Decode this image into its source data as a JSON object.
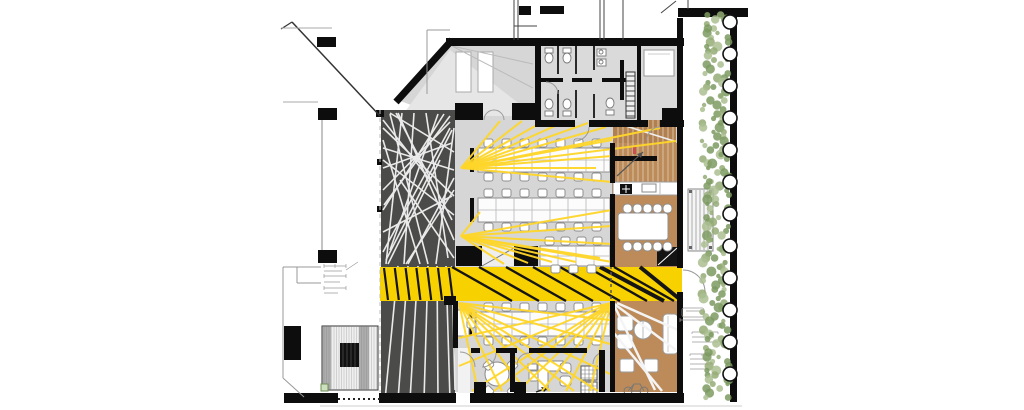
{
  "meta": {
    "title": "office-floor-plan",
    "description": "Architectural floor plan of an office level: entry ramp top-left, sanitary block top, dark gallery with white web pattern on the left, open office with three desk rows, yellow circulation band with black stripes, wooden zone with stair, kitchenette and meeting table, lounge bottom-right, outdoor deck with bench and planting hedge along the right edge."
  },
  "palette": {
    "wall": "#0d0d0d",
    "floor_grey": "#d6d6d6",
    "floor_grey_light": "#e4e4e4",
    "bath_grey": "#dadada",
    "dark_zone": "#4b4b49",
    "web_line": "#eaeaea",
    "band_yellow": "#f8d100",
    "stripe_black": "#151515",
    "ray_yellow": "#ffd629",
    "wood_brown": "#bd8b59",
    "wood_brown_dark": "#b28050",
    "tread_line": "#dcc9ab",
    "furniture_stroke": "#8f8f8f",
    "white": "#ffffff",
    "hedge_green_dark": "#7d9a60",
    "hedge_green": "#94ac75",
    "hedge_green_light": "#abc092",
    "door_arc": "#9a9a9a",
    "annotation_grey": "#9a9a9a",
    "dashed_grey": "#bdbdbd",
    "ground_line": "#cfcfcf"
  },
  "zones": [
    {
      "name": "entry-ramp",
      "fill": "floor_grey"
    },
    {
      "name": "sanitary-block",
      "fill": "bath_grey"
    },
    {
      "name": "dark-gallery",
      "fill": "dark_zone"
    },
    {
      "name": "open-office-upper",
      "fill": "floor_grey"
    },
    {
      "name": "circulation-band",
      "fill": "band_yellow"
    },
    {
      "name": "wood-zone",
      "fill": "wood_brown"
    },
    {
      "name": "open-office-lower",
      "fill": "floor_grey"
    },
    {
      "name": "lounge",
      "fill": "wood_brown"
    },
    {
      "name": "deck",
      "fill": "white"
    },
    {
      "name": "hedge",
      "fill": "hedge_green"
    }
  ],
  "web_lines": [
    [
      383,
      128,
      454,
      196
    ],
    [
      383,
      148,
      454,
      170
    ],
    [
      383,
      168,
      452,
      143
    ],
    [
      383,
      190,
      450,
      122
    ],
    [
      383,
      210,
      444,
      114
    ],
    [
      383,
      232,
      452,
      196
    ],
    [
      383,
      252,
      450,
      128
    ],
    [
      390,
      114,
      428,
      264
    ],
    [
      402,
      113,
      386,
      264
    ],
    [
      414,
      113,
      404,
      264
    ],
    [
      426,
      113,
      448,
      258
    ],
    [
      438,
      114,
      390,
      250
    ],
    [
      450,
      116,
      384,
      205
    ],
    [
      452,
      130,
      386,
      260
    ],
    [
      454,
      152,
      390,
      113
    ],
    [
      454,
      178,
      408,
      264
    ],
    [
      454,
      215,
      383,
      160
    ],
    [
      454,
      240,
      398,
      113
    ],
    [
      420,
      264,
      383,
      140
    ],
    [
      436,
      264,
      454,
      128
    ],
    [
      383,
      120,
      430,
      180
    ],
    [
      400,
      180,
      454,
      258
    ],
    [
      388,
      264,
      440,
      160
    ],
    [
      406,
      264,
      454,
      190
    ],
    [
      396,
      113,
      452,
      220
    ],
    [
      398,
      266,
      385,
      400
    ],
    [
      408,
      266,
      398,
      400
    ],
    [
      418,
      266,
      410,
      400
    ],
    [
      428,
      266,
      424,
      400
    ],
    [
      437,
      266,
      438,
      400
    ],
    [
      446,
      266,
      450,
      400
    ],
    [
      452,
      266,
      455,
      390
    ]
  ],
  "ray_lines": [
    [
      461,
      168,
      500,
      121
    ],
    [
      461,
      168,
      522,
      121
    ],
    [
      461,
      168,
      544,
      121
    ],
    [
      461,
      168,
      566,
      121
    ],
    [
      461,
      168,
      588,
      123
    ],
    [
      461,
      168,
      606,
      127
    ],
    [
      461,
      168,
      612,
      140
    ],
    [
      461,
      168,
      612,
      156
    ],
    [
      461,
      168,
      660,
      128
    ],
    [
      461,
      168,
      676,
      141
    ],
    [
      461,
      168,
      596,
      168
    ],
    [
      461,
      168,
      612,
      182
    ],
    [
      461,
      236,
      612,
      210
    ],
    [
      461,
      236,
      612,
      226
    ],
    [
      461,
      236,
      612,
      244
    ],
    [
      461,
      236,
      600,
      258
    ],
    [
      461,
      236,
      576,
      262
    ],
    [
      461,
      236,
      552,
      262
    ],
    [
      461,
      236,
      528,
      263
    ],
    [
      461,
      236,
      504,
      264
    ],
    [
      461,
      236,
      612,
      262
    ],
    [
      461,
      236,
      480,
      212
    ],
    [
      459,
      303,
      478,
      391
    ],
    [
      459,
      303,
      502,
      391
    ],
    [
      459,
      303,
      526,
      391
    ],
    [
      459,
      303,
      550,
      391
    ],
    [
      459,
      303,
      574,
      391
    ],
    [
      459,
      303,
      598,
      391
    ],
    [
      459,
      303,
      610,
      374
    ],
    [
      459,
      303,
      610,
      344
    ],
    [
      459,
      303,
      610,
      320
    ],
    [
      611,
      303,
      590,
      391
    ],
    [
      611,
      303,
      566,
      391
    ],
    [
      611,
      303,
      542,
      391
    ],
    [
      611,
      303,
      518,
      391
    ],
    [
      611,
      303,
      494,
      391
    ],
    [
      611,
      303,
      472,
      391
    ],
    [
      611,
      303,
      459,
      366
    ],
    [
      611,
      303,
      459,
      338
    ]
  ],
  "white_rays": [
    [
      613,
      303,
      676,
      350
    ],
    [
      613,
      303,
      655,
      390
    ],
    [
      617,
      303,
      678,
      330
    ],
    [
      613,
      332,
      662,
      391
    ]
  ],
  "band": {
    "x": 380,
    "y": 267,
    "w": 302,
    "h": 34,
    "dark_stripes": {
      "x_start": 384,
      "x_end": 450,
      "step": 10.8,
      "lean": 4
    },
    "main_stripes": [
      [
        452,
        512
      ],
      [
        479,
        539
      ],
      [
        506,
        566
      ],
      [
        533,
        593
      ],
      [
        560,
        620
      ],
      [
        587,
        647
      ],
      [
        614,
        674
      ]
    ],
    "bold_stripes": [
      [
        600,
        664
      ],
      [
        640,
        696
      ]
    ]
  },
  "desk_rows": [
    {
      "x": 478,
      "y": 148,
      "w": 132,
      "h": 24,
      "tick": [
        470,
        148
      ],
      "chairs_top_x": [
        484,
        502,
        520,
        538,
        556,
        574,
        592
      ],
      "chair_y_top": 139,
      "chairs_bottom_x": [
        484,
        502,
        520,
        538,
        556,
        574,
        592
      ],
      "chair_y_bottom": 173
    },
    {
      "x": 478,
      "y": 198,
      "w": 132,
      "h": 24,
      "tick": [
        470,
        198
      ],
      "chairs_top_x": [
        484,
        502,
        520,
        538,
        556,
        574,
        592
      ],
      "chair_y_top": 189,
      "chairs_bottom_x": [
        484,
        502,
        520,
        538,
        556,
        574,
        592
      ],
      "chair_y_bottom": 223
    },
    {
      "x": 540,
      "y": 246,
      "w": 70,
      "h": 20,
      "tick": null,
      "chairs_top_x": [
        545,
        561,
        577,
        593
      ],
      "chair_y_top": 237,
      "chairs_bottom_x": [
        551,
        569,
        587
      ],
      "chair_y_bottom": 265
    },
    {
      "x": 476,
      "y": 312,
      "w": 134,
      "h": 24,
      "tick": [
        468,
        312
      ],
      "chairs_top_x": [
        484,
        502,
        520,
        538,
        556,
        574,
        592
      ],
      "chair_y_top": 303,
      "chairs_bottom_x": [
        484,
        502,
        520,
        538,
        556,
        574,
        592
      ],
      "chair_y_bottom": 337
    }
  ],
  "meeting_table": {
    "x": 618,
    "y": 213,
    "w": 50,
    "h": 27,
    "chair_xs": [
      623,
      633,
      643,
      653,
      663
    ],
    "chair_y_top": 204,
    "chair_y_bottom": 242
  },
  "round_table": {
    "cx": 497,
    "cy": 374,
    "r": 12,
    "chairs": [
      [
        484,
        361,
        -45
      ],
      [
        508,
        361,
        45
      ],
      [
        484,
        387,
        45
      ],
      [
        508,
        387,
        -45
      ]
    ]
  },
  "stairs": {
    "flights": [
      {
        "x": 613,
        "y": 120,
        "w": 63,
        "h": 23,
        "step": 5
      },
      {
        "x": 613,
        "y": 143,
        "w": 63,
        "h": 39,
        "step": 5
      }
    ],
    "rail": [
      615,
      156,
      42,
      5
    ],
    "cut_line": [
      613,
      122,
      674,
      141
    ]
  },
  "columns_right": {
    "cx": 730,
    "r": 7,
    "y_start": 22,
    "y_step": 32,
    "count": 12
  },
  "hedge": {
    "x0": 702,
    "x1": 734,
    "y0": 15,
    "y1": 401
  }
}
